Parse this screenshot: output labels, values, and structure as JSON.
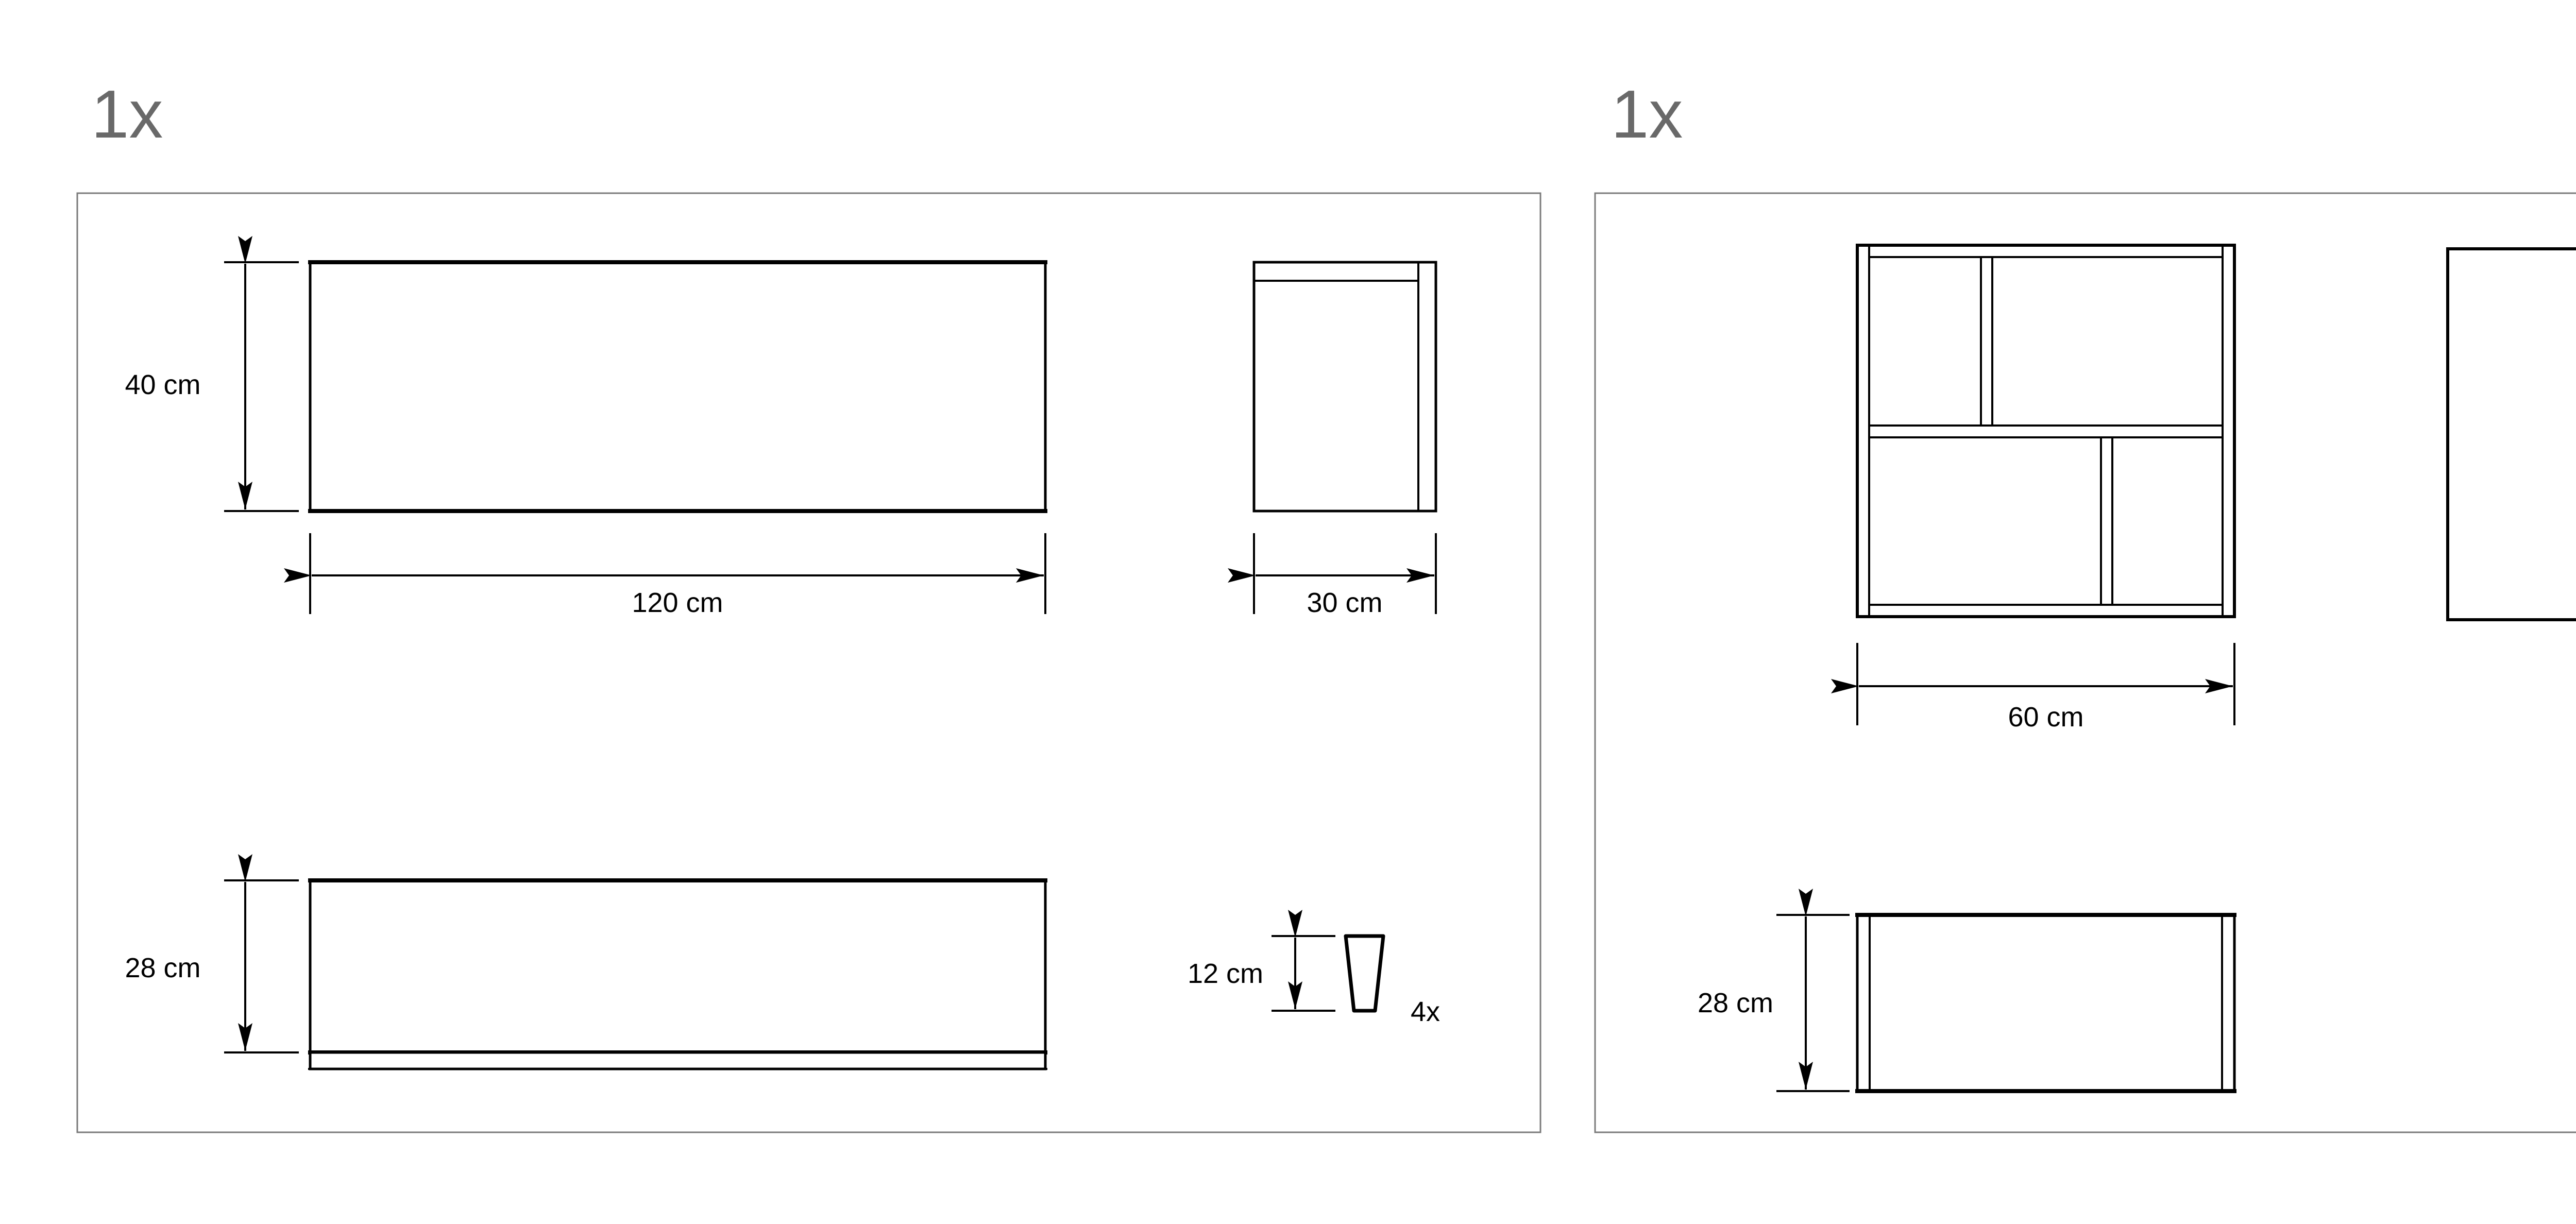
{
  "diagram": {
    "left_panel": {
      "quantity": "1x",
      "tabletop_height": "40 cm",
      "tabletop_width": "120 cm",
      "side_depth": "30 cm",
      "apron_height": "28 cm",
      "leg_height": "12 cm",
      "leg_count": "4x"
    },
    "right_panel": {
      "quantity": "1x",
      "shelf_width": "60 cm",
      "side_height": "60 cm",
      "bottom_height": "28 cm"
    },
    "colors": {
      "outline": "#000000",
      "panel_border": "#7b7b7b",
      "quantity_text": "#696969",
      "background": "#ffffff"
    }
  }
}
